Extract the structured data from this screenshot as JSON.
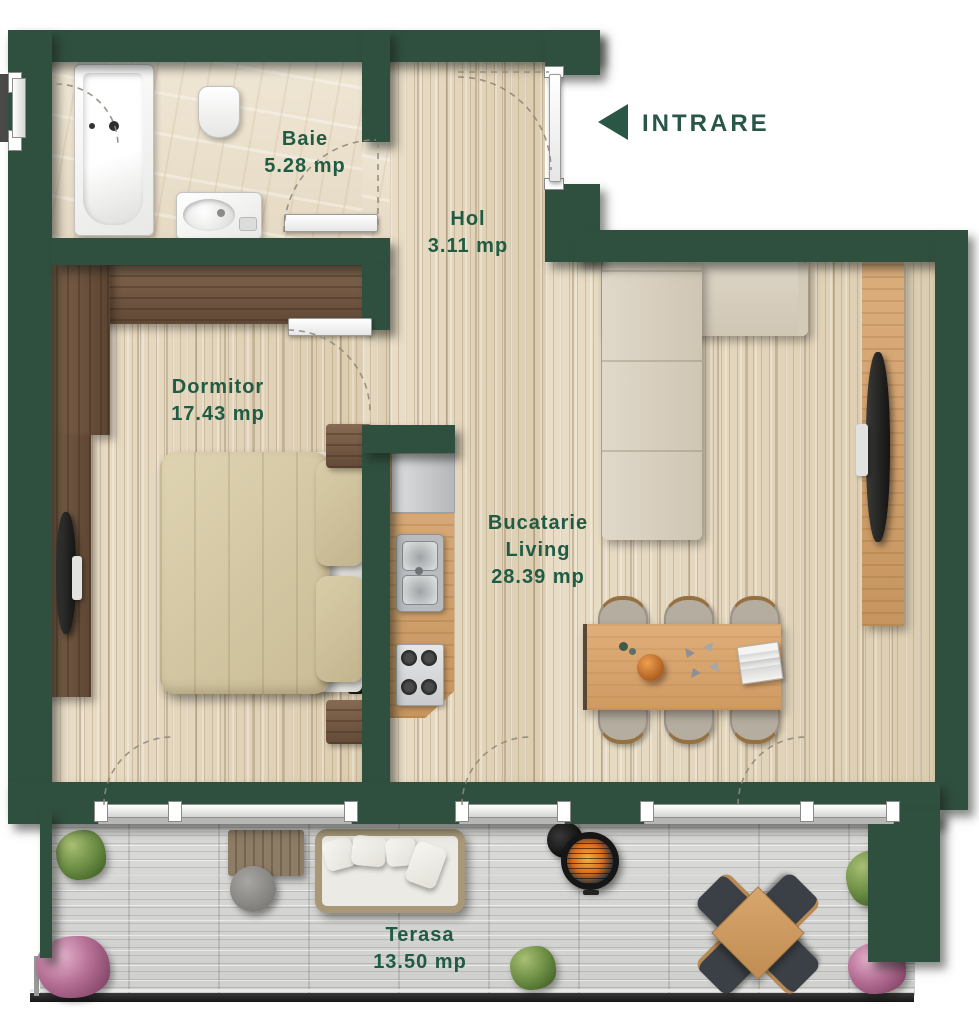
{
  "plan": {
    "type": "apartment-floor-plan"
  },
  "entrance": {
    "label": "INTRARE",
    "icon": "left-arrow"
  },
  "rooms": {
    "baie": {
      "name": "Baie",
      "area": "5.28 mp"
    },
    "hol": {
      "name": "Hol",
      "area": "3.11 mp"
    },
    "dormitor": {
      "name": "Dormitor",
      "area": "17.43 mp"
    },
    "bucatarie_living": {
      "line1": "Bucatarie",
      "line2": "Living",
      "area": "28.39 mp"
    },
    "terasa": {
      "name": "Terasa",
      "area": "13.50 mp"
    }
  },
  "colors": {
    "wall": "#30503f",
    "label_text": "#1e5c44",
    "interior_wood_floor": "#e4d7c0",
    "bathroom_tile_floor": "#ece2cf",
    "terrace_floor": "#d6d6d4",
    "wardrobe_wood": "#6f5742",
    "kitchen_counter": "#d4a473",
    "dining_table": "#d9a977",
    "bed_duvet": "#d6caa8",
    "sofa": "#d9d1c1",
    "grill_fire": "#e88c2a"
  },
  "icons": {
    "entrance_arrow": "left-pointing-triangle",
    "door_swing": "dashed-quarter-arc"
  }
}
